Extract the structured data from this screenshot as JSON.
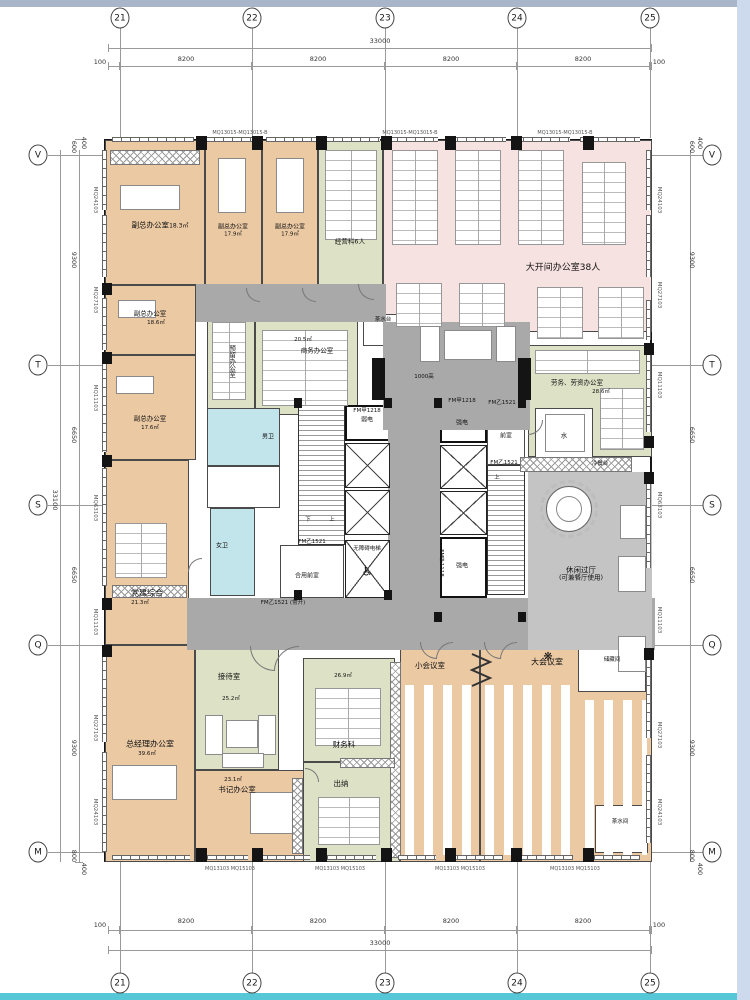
{
  "page": {
    "top_strip": "#a9b6ca",
    "bottom_strip": "#55c7d7",
    "right_strip": "#cdd9ec"
  },
  "colors": {
    "office_tan": "#ebc9a3",
    "open_office_pink": "#f6e2e0",
    "meeting_green": "#dde1c5",
    "toilet_blue": "#c2e4eb",
    "corridor_gray": "#a9a9a9",
    "wall": "#161616"
  },
  "grid": {
    "cols": [
      "21",
      "22",
      "23",
      "24",
      "25"
    ],
    "rows": [
      "V",
      "T",
      "S",
      "Q",
      "M"
    ],
    "h_total": "33000",
    "h_seg": "8200",
    "h_end": "100",
    "v_total": "33100",
    "v_segs": [
      "9300",
      "6650",
      "6650",
      "9300"
    ],
    "v_top": [
      "600",
      "400"
    ],
    "v_bottom": [
      "800",
      "400"
    ]
  },
  "wall_labels": {
    "left": [
      "MQ24103",
      "MQ27103",
      "MQ11103",
      "MQ63103",
      "MQ11103",
      "MQ27103",
      "MQ24103"
    ],
    "right": [
      "MQ24103",
      "MQ27103",
      "MQ11103",
      "MQ63103",
      "MQ11103",
      "MQ27103",
      "MQ24103"
    ],
    "top": "MQ13015-MQ13015-B",
    "bottom": "MQ13103 MQ15103"
  },
  "rooms": {
    "vice1": {
      "name": "副总办公室",
      "area": "18.3㎡"
    },
    "vice2": {
      "name": "副总办公室",
      "area": "17.9㎡"
    },
    "vice3": {
      "name": "副总办公室",
      "area": "17.9㎡"
    },
    "ops": {
      "name": "经营科6人"
    },
    "open_office": {
      "name": "大开间办公室38人"
    },
    "vice4": {
      "name": "副总办公室",
      "area": "18.6㎡"
    },
    "vice5": {
      "name": "副总办公室",
      "area": "17.6㎡"
    },
    "reserved": {
      "name": "预留办公室"
    },
    "business": {
      "name": "商务办公室",
      "area": "20.5㎡"
    },
    "tea_counter": {
      "name": "茶水台"
    },
    "labor": {
      "name": "劳务、劳资办公室",
      "area": "28.6㎡"
    },
    "water": {
      "name": "水"
    },
    "buffet": {
      "name": "冷餐台"
    },
    "leisure": {
      "name": "休闲过厅",
      "sub": "(可兼餐厅使用)"
    },
    "party": {
      "name": "党建综合",
      "area": "21.3㎡"
    },
    "women_wc": {
      "name": "女卫"
    },
    "men_wc": {
      "name": "男卫"
    },
    "gm": {
      "name": "总经理办公室",
      "area": "39.6㎡"
    },
    "reception": {
      "name": "接待室",
      "area": "25.2㎡"
    },
    "secretary": {
      "name": "书记办公室",
      "area": "23.1㎡"
    },
    "finance": {
      "name": "财务科",
      "area": "26.9㎡"
    },
    "cashier": {
      "name": "出纳"
    },
    "small_meeting": {
      "name": "小会议室"
    },
    "large_meeting": {
      "name": "大会议室"
    },
    "storage": {
      "name": "储藏间"
    },
    "pantry": {
      "name": "茶水间"
    }
  },
  "core": {
    "weak": "弱电",
    "strong": "强电",
    "front": "前室",
    "shared_front": "合用前室",
    "accessible": "无障碍电梯",
    "wheelchair": "♿",
    "up": "上",
    "down": "下",
    "lobby_note": "1000高"
  },
  "doors": {
    "a1218": "FM甲1218",
    "a1118": "FM甲1118",
    "b1521": "FM乙1521",
    "b1521_open": "FM乙1521 (常开)"
  }
}
